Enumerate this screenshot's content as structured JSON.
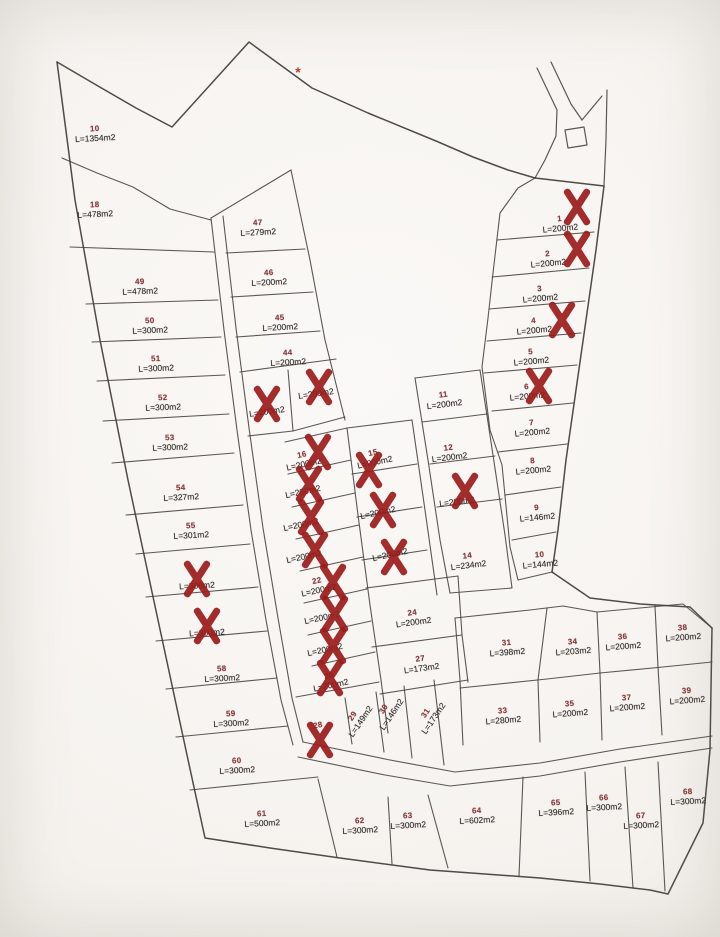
{
  "map": {
    "kind": "land-subdivision-parcel-plan",
    "asterisk": {
      "glyph": "*",
      "x": 298,
      "y": 72
    }
  },
  "colors": {
    "line": "#46413c",
    "number": "#8d3a3a",
    "area": "#2f2c2a",
    "x_mark": "#9b1c1c",
    "asterisk": "#c03a2e",
    "paper": "#f6f4f1"
  },
  "plots": [
    {
      "num": "10",
      "area": "L=1354m2",
      "x": 95,
      "y": 134,
      "rot": -3,
      "sold": false
    },
    {
      "num": "18",
      "area": "L=478m2",
      "x": 95,
      "y": 210,
      "rot": -3,
      "sold": false
    },
    {
      "num": "49",
      "area": "L=478m2",
      "x": 140,
      "y": 287,
      "rot": -2,
      "sold": false
    },
    {
      "num": "50",
      "area": "L=300m2",
      "x": 150,
      "y": 326,
      "rot": -2,
      "sold": false
    },
    {
      "num": "51",
      "area": "L=300m2",
      "x": 156,
      "y": 364,
      "rot": -2,
      "sold": false
    },
    {
      "num": "52",
      "area": "L=300m2",
      "x": 163,
      "y": 403,
      "rot": -2,
      "sold": false
    },
    {
      "num": "53",
      "area": "L=300m2",
      "x": 170,
      "y": 443,
      "rot": -2,
      "sold": false
    },
    {
      "num": "54",
      "area": "L=327m2",
      "x": 181,
      "y": 493,
      "rot": -3,
      "sold": false
    },
    {
      "num": "55",
      "area": "L=301m2",
      "x": 191,
      "y": 531,
      "rot": -3,
      "sold": false
    },
    {
      "num": "",
      "area": "L=300m2",
      "x": 197,
      "y": 586,
      "rot": -3,
      "sold": true
    },
    {
      "num": "",
      "area": "L=300m2",
      "x": 207,
      "y": 633,
      "rot": -3,
      "sold": true
    },
    {
      "num": "58",
      "area": "L=300m2",
      "x": 222,
      "y": 674,
      "rot": -3,
      "sold": false
    },
    {
      "num": "59",
      "area": "L=300m2",
      "x": 231,
      "y": 719,
      "rot": -3,
      "sold": false
    },
    {
      "num": "60",
      "area": "L=300m2",
      "x": 237,
      "y": 766,
      "rot": -3,
      "sold": false
    },
    {
      "num": "61",
      "area": "L=500m2",
      "x": 262,
      "y": 819,
      "rot": -3,
      "sold": false
    },
    {
      "num": "47",
      "area": "L=279m2",
      "x": 258,
      "y": 228,
      "rot": -3,
      "sold": false
    },
    {
      "num": "46",
      "area": "L=200m2",
      "x": 269,
      "y": 278,
      "rot": -3,
      "sold": false
    },
    {
      "num": "45",
      "area": "L=200m2",
      "x": 280,
      "y": 323,
      "rot": -3,
      "sold": false
    },
    {
      "num": "44",
      "area": "L=200m2",
      "x": 288,
      "y": 358,
      "rot": -3,
      "sold": false
    },
    {
      "num": "",
      "area": "L=200m2",
      "x": 267,
      "y": 412,
      "rot": -8,
      "sold": true
    },
    {
      "num": "",
      "area": "L=200m2",
      "x": 316,
      "y": 394,
      "rot": -8,
      "sold": true
    },
    {
      "num": "16",
      "area": "L=200m2",
      "x": 303,
      "y": 460,
      "rot": -12,
      "sold": true
    },
    {
      "num": "",
      "area": "L=200m2",
      "x": 303,
      "y": 492,
      "rot": -12,
      "sold": true
    },
    {
      "num": "",
      "area": "L=200m2",
      "x": 301,
      "y": 525,
      "rot": -12,
      "sold": true
    },
    {
      "num": "",
      "area": "L=200m2",
      "x": 304,
      "y": 557,
      "rot": -12,
      "sold": true
    },
    {
      "num": "22",
      "area": "L=200m2",
      "x": 318,
      "y": 586,
      "rot": -12,
      "sold": true
    },
    {
      "num": "",
      "area": "L=200m2",
      "x": 322,
      "y": 618,
      "rot": -12,
      "sold": true
    },
    {
      "num": "",
      "area": "L=200m2",
      "x": 325,
      "y": 650,
      "rot": -12,
      "sold": true
    },
    {
      "num": "26",
      "area": "L=200m2",
      "x": 330,
      "y": 681,
      "rot": -12,
      "sold": true
    },
    {
      "num": "28",
      "area": "",
      "x": 318,
      "y": 726,
      "rot": -10,
      "sold": true
    },
    {
      "num": "15",
      "area": "L=200m2",
      "x": 374,
      "y": 458,
      "rot": -12,
      "sold": true
    },
    {
      "num": "",
      "area": "L=200m2",
      "x": 378,
      "y": 513,
      "rot": -12,
      "sold": true
    },
    {
      "num": "",
      "area": "L=200m2",
      "x": 390,
      "y": 555,
      "rot": -12,
      "sold": true
    },
    {
      "num": "24",
      "area": "L=200m2",
      "x": 413,
      "y": 618,
      "rot": -8,
      "sold": false
    },
    {
      "num": "27",
      "area": "L=173m2",
      "x": 421,
      "y": 664,
      "rot": -8,
      "sold": false
    },
    {
      "num": "29",
      "area": "L=149m2",
      "x": 357,
      "y": 719,
      "rot": -56,
      "sold": false
    },
    {
      "num": "30",
      "area": "L=146m2",
      "x": 388,
      "y": 712,
      "rot": -56,
      "sold": false
    },
    {
      "num": "31",
      "area": "L=173m2",
      "x": 430,
      "y": 716,
      "rot": -56,
      "sold": false
    },
    {
      "num": "11",
      "area": "L=200m2",
      "x": 444,
      "y": 400,
      "rot": -7,
      "sold": false
    },
    {
      "num": "12",
      "area": "L=200m2",
      "x": 449,
      "y": 453,
      "rot": -7,
      "sold": false
    },
    {
      "num": "",
      "area": "L=200m2",
      "x": 457,
      "y": 502,
      "rot": -7,
      "sold": true
    },
    {
      "num": "14",
      "area": "L=234m2",
      "x": 468,
      "y": 561,
      "rot": -7,
      "sold": false
    },
    {
      "num": "1",
      "area": "L=200m2",
      "x": 560,
      "y": 224,
      "rot": -5,
      "sold": true
    },
    {
      "num": "2",
      "area": "L=200m2",
      "x": 548,
      "y": 259,
      "rot": -5,
      "sold": true
    },
    {
      "num": "3",
      "area": "L=200m2",
      "x": 540,
      "y": 294,
      "rot": -5,
      "sold": false
    },
    {
      "num": "4",
      "area": "L=200m2",
      "x": 534,
      "y": 326,
      "rot": -5,
      "sold": true
    },
    {
      "num": "5",
      "area": "L=200m2",
      "x": 531,
      "y": 357,
      "rot": -5,
      "sold": false
    },
    {
      "num": "6",
      "area": "L=200m2",
      "x": 527,
      "y": 392,
      "rot": -5,
      "sold": true
    },
    {
      "num": "7",
      "area": "L=200m2",
      "x": 532,
      "y": 428,
      "rot": -5,
      "sold": false
    },
    {
      "num": "8",
      "area": "L=200m2",
      "x": 533,
      "y": 466,
      "rot": -5,
      "sold": false
    },
    {
      "num": "9",
      "area": "L=146m2",
      "x": 537,
      "y": 513,
      "rot": -5,
      "sold": false
    },
    {
      "num": "10",
      "area": "L=144m2",
      "x": 540,
      "y": 560,
      "rot": -5,
      "sold": false
    },
    {
      "num": "31",
      "area": "L=398m2",
      "x": 507,
      "y": 648,
      "rot": -4,
      "sold": false
    },
    {
      "num": "34",
      "area": "L=203m2",
      "x": 573,
      "y": 647,
      "rot": -4,
      "sold": false
    },
    {
      "num": "36",
      "area": "L=200m2",
      "x": 623,
      "y": 642,
      "rot": -4,
      "sold": false
    },
    {
      "num": "38",
      "area": "L=200m2",
      "x": 683,
      "y": 633,
      "rot": -4,
      "sold": false
    },
    {
      "num": "33",
      "area": "L=280m2",
      "x": 503,
      "y": 716,
      "rot": -4,
      "sold": false
    },
    {
      "num": "35",
      "area": "L=200m2",
      "x": 570,
      "y": 709,
      "rot": -4,
      "sold": false
    },
    {
      "num": "37",
      "area": "L=200m2",
      "x": 627,
      "y": 703,
      "rot": -4,
      "sold": false
    },
    {
      "num": "39",
      "area": "L=200m2",
      "x": 687,
      "y": 696,
      "rot": -4,
      "sold": false
    },
    {
      "num": "62",
      "area": "L=300m2",
      "x": 360,
      "y": 826,
      "rot": -3,
      "sold": false
    },
    {
      "num": "63",
      "area": "L=300m2",
      "x": 408,
      "y": 821,
      "rot": -3,
      "sold": false
    },
    {
      "num": "64",
      "area": "L=602m2",
      "x": 477,
      "y": 816,
      "rot": -3,
      "sold": false
    },
    {
      "num": "65",
      "area": "L=396m2",
      "x": 556,
      "y": 808,
      "rot": -3,
      "sold": false
    },
    {
      "num": "66",
      "area": "L=300m2",
      "x": 604,
      "y": 803,
      "rot": -3,
      "sold": false
    },
    {
      "num": "67",
      "area": "L=300m2",
      "x": 641,
      "y": 821,
      "rot": -3,
      "sold": false
    },
    {
      "num": "68",
      "area": "L=300m2",
      "x": 688,
      "y": 797,
      "rot": -3,
      "sold": false
    }
  ],
  "x_marks": [
    {
      "x": 577,
      "y": 207
    },
    {
      "x": 577,
      "y": 249
    },
    {
      "x": 562,
      "y": 320
    },
    {
      "x": 539,
      "y": 386
    },
    {
      "x": 267,
      "y": 404
    },
    {
      "x": 319,
      "y": 387
    },
    {
      "x": 318,
      "y": 452
    },
    {
      "x": 309,
      "y": 484
    },
    {
      "x": 311,
      "y": 517
    },
    {
      "x": 315,
      "y": 550
    },
    {
      "x": 333,
      "y": 582
    },
    {
      "x": 335,
      "y": 614
    },
    {
      "x": 333,
      "y": 646
    },
    {
      "x": 330,
      "y": 678
    },
    {
      "x": 320,
      "y": 740
    },
    {
      "x": 369,
      "y": 470
    },
    {
      "x": 383,
      "y": 510
    },
    {
      "x": 394,
      "y": 557
    },
    {
      "x": 465,
      "y": 491
    },
    {
      "x": 197,
      "y": 579
    },
    {
      "x": 207,
      "y": 626
    }
  ]
}
